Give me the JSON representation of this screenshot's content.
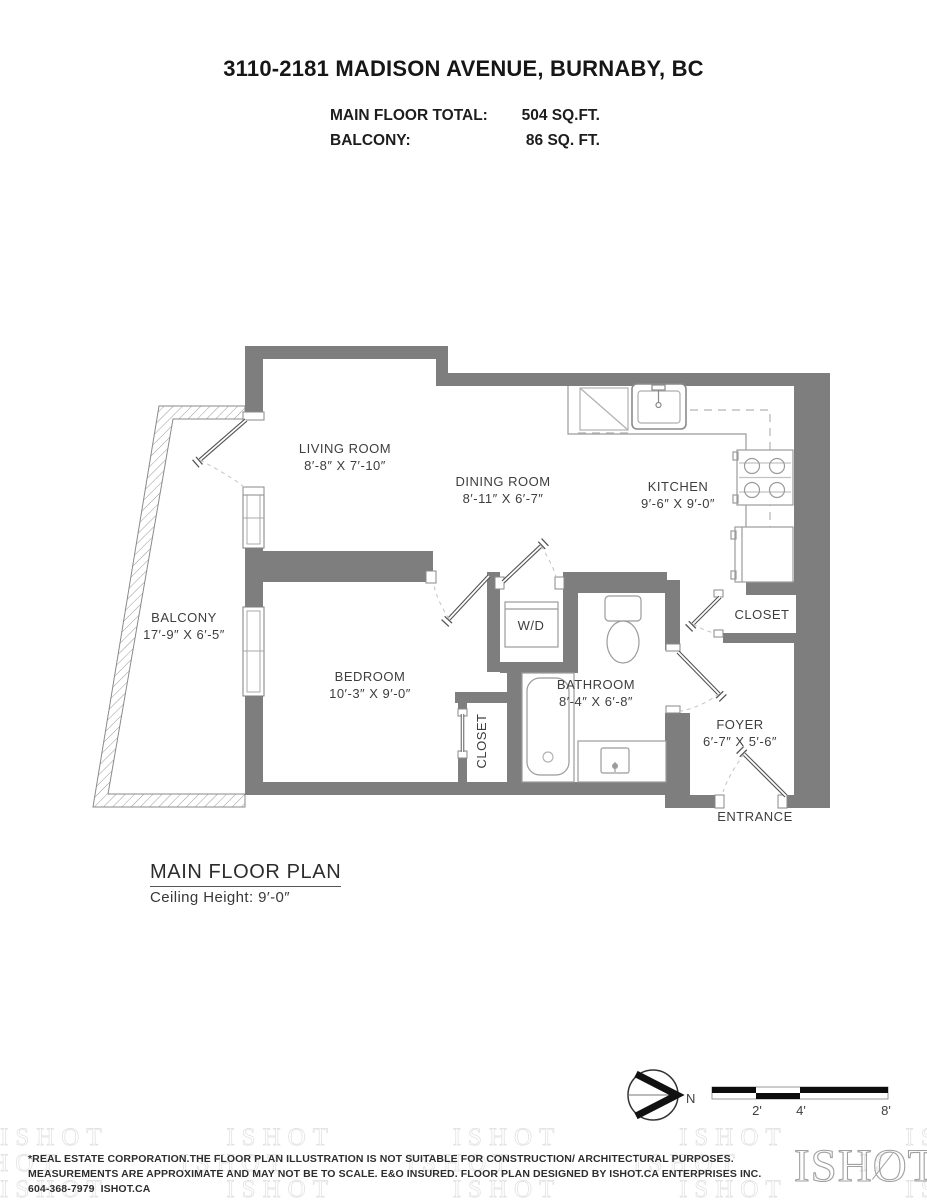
{
  "title": "3110-2181 MADISON AVENUE, BURNABY, BC",
  "summary": {
    "main_floor_label": "MAIN FLOOR TOTAL:",
    "main_floor_value": "504 SQ.FT.",
    "balcony_label": "BALCONY:",
    "balcony_value": "86 SQ. FT."
  },
  "rooms": {
    "living": {
      "name": "LIVING ROOM",
      "dims": "8′-8″ X 7′-10″"
    },
    "dining": {
      "name": "DINING ROOM",
      "dims": "8′-11″ X 6′-7″"
    },
    "kitchen": {
      "name": "KITCHEN",
      "dims": "9′-6″ X 9′-0″"
    },
    "balcony": {
      "name": "BALCONY",
      "dims": "17′-9″ X 6′-5″"
    },
    "bedroom": {
      "name": "BEDROOM",
      "dims": "10′-3″ X 9′-0″"
    },
    "bathroom": {
      "name": "BATHROOM",
      "dims": "8′-4″ X 6′-8″"
    },
    "foyer": {
      "name": "FOYER",
      "dims": "6′-7″ X 5′-6″"
    },
    "wd": "W/D",
    "closet_bedroom": "CLOSET",
    "closet_entry": "CLOSET",
    "entrance": "ENTRANCE"
  },
  "plan_heading": {
    "label": "MAIN FLOOR PLAN",
    "ceiling": "Ceiling Height: 9′-0″"
  },
  "compass": {
    "label": "N"
  },
  "scale_bar": {
    "ticks": [
      "2'",
      "4'",
      "8'"
    ]
  },
  "footer": {
    "line1": "*REAL ESTATE CORPORATION.THE FLOOR PLAN ILLUSTRATION IS NOT SUITABLE FOR CONSTRUCTION/ ARCHITECTURAL PURPOSES.",
    "line2": "MEASUREMENTS ARE APPROXIMATE AND MAY NOT BE TO SCALE. E&O INSURED. FLOOR PLAN DESIGNED BY ISHOT.CA ENTERPRISES INC.",
    "line3": "604-368-7979  ISHOT.CA",
    "logo": "ISHOT",
    "watermark_text": "ISHOT"
  },
  "colors": {
    "wall": "#7e7e7e",
    "fixture_line": "#9b9b9b",
    "text": "#3e3e3e",
    "black": "#111111"
  }
}
